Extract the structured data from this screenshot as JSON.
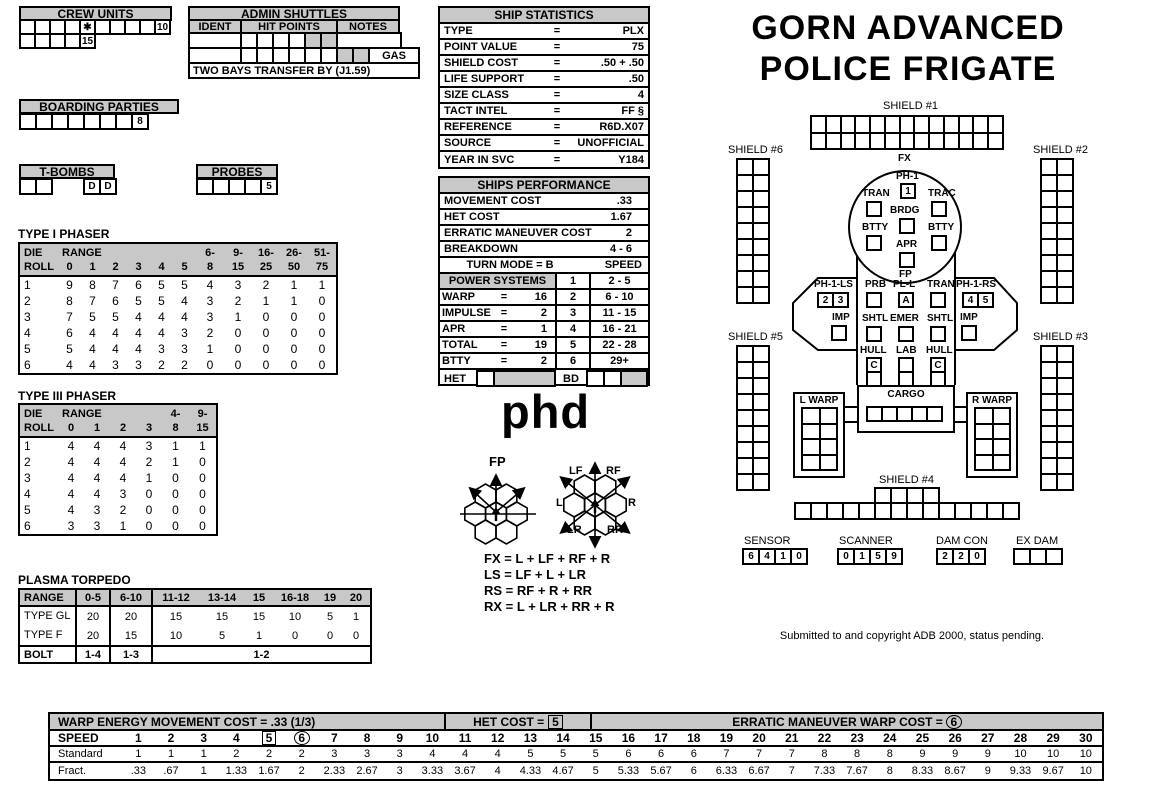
{
  "title": {
    "line1": "GORN ADVANCED",
    "line2": "POLICE FRIGATE"
  },
  "colors": {
    "ink": "#000000",
    "panel_gray": "#c8c8c8",
    "paper": "#ffffff"
  },
  "crew_units": {
    "title": "CREW UNITS",
    "row1": [
      "",
      "",
      "",
      "",
      "✱",
      "",
      "",
      "",
      "",
      "10"
    ],
    "row2": [
      "",
      "",
      "",
      "",
      "15"
    ]
  },
  "admin_shuttles": {
    "title": "ADMIN SHUTTLES",
    "col_ident": "IDENT",
    "col_hit": "HIT POINTS",
    "col_notes": "NOTES",
    "row1": [
      "",
      "",
      "",
      "",
      "~",
      "~"
    ],
    "row2": [
      "",
      "",
      "",
      "",
      "",
      "",
      "~",
      "~"
    ],
    "gas": "GAS",
    "note": "TWO BAYS TRANSFER BY (J1.59)"
  },
  "boarding_parties": {
    "title": "BOARDING PARTIES",
    "cells": [
      "",
      "",
      "",
      "",
      "",
      "",
      "",
      "8"
    ]
  },
  "t_bombs": {
    "title": "T-BOMBS",
    "left": [
      "",
      ""
    ],
    "right": [
      "D",
      "D"
    ]
  },
  "probes": {
    "title": "PROBES",
    "cells": [
      "",
      "",
      "",
      "",
      "5"
    ]
  },
  "ship_statistics": {
    "title": "SHIP STATISTICS",
    "rows": [
      [
        "TYPE",
        "=",
        "PLX"
      ],
      [
        "POINT VALUE",
        "=",
        "75"
      ],
      [
        "SHIELD COST",
        "=",
        ".50 + .50"
      ],
      [
        "LIFE SUPPORT",
        "=",
        ".50"
      ],
      [
        "SIZE CLASS",
        "=",
        "4"
      ],
      [
        "TACT INTEL",
        "=",
        "FF §"
      ],
      [
        "REFERENCE",
        "=",
        "R6D.X07"
      ],
      [
        "SOURCE",
        "=",
        "UNOFFICIAL"
      ],
      [
        "YEAR IN SVC",
        "=",
        "Y184"
      ]
    ]
  },
  "ships_performance": {
    "title": "SHIPS PERFORMANCE",
    "rows": [
      [
        "MOVEMENT COST",
        ".33"
      ],
      [
        "HET COST",
        "1.67"
      ],
      [
        "ERRATIC MANEUVER COST",
        "2"
      ],
      [
        "BREAKDOWN",
        "4 - 6"
      ]
    ],
    "turn_mode": "TURN MODE = B",
    "speed_header": "SPEED",
    "power_title": "POWER SYSTEMS",
    "power_rows": [
      [
        "WARP",
        "=",
        "16"
      ],
      [
        "IMPULSE",
        "=",
        "2"
      ],
      [
        "APR",
        "=",
        "1"
      ],
      [
        "TOTAL",
        "=",
        "19"
      ],
      [
        "BTTY",
        "=",
        "2"
      ]
    ],
    "speed_rows": [
      [
        "1",
        "2 - 5"
      ],
      [
        "2",
        "6 - 10"
      ],
      [
        "3",
        "11 - 15"
      ],
      [
        "4",
        "16 - 21"
      ],
      [
        "5",
        "22 - 28"
      ],
      [
        "6",
        "29+"
      ]
    ],
    "het_label": "HET",
    "bd_label": "BD"
  },
  "type1_phaser": {
    "title": "TYPE I PHASER",
    "header_top": [
      "DIE",
      "RANGE",
      "",
      "",
      "",
      "",
      "",
      "6-",
      "9-",
      "16-",
      "26-",
      "51-"
    ],
    "header_bot": [
      "ROLL",
      "0",
      "1",
      "2",
      "3",
      "4",
      "5",
      "8",
      "15",
      "25",
      "50",
      "75"
    ],
    "rows": [
      [
        "1",
        "9",
        "8",
        "7",
        "6",
        "5",
        "5",
        "4",
        "3",
        "2",
        "1",
        "1"
      ],
      [
        "2",
        "8",
        "7",
        "6",
        "5",
        "5",
        "4",
        "3",
        "2",
        "1",
        "1",
        "0"
      ],
      [
        "3",
        "7",
        "5",
        "5",
        "4",
        "4",
        "4",
        "3",
        "1",
        "0",
        "0",
        "0"
      ],
      [
        "4",
        "6",
        "4",
        "4",
        "4",
        "4",
        "3",
        "2",
        "0",
        "0",
        "0",
        "0"
      ],
      [
        "5",
        "5",
        "4",
        "4",
        "4",
        "3",
        "3",
        "1",
        "0",
        "0",
        "0",
        "0"
      ],
      [
        "6",
        "4",
        "4",
        "3",
        "3",
        "2",
        "2",
        "0",
        "0",
        "0",
        "0",
        "0"
      ]
    ]
  },
  "type3_phaser": {
    "title": "TYPE III PHASER",
    "header_top": [
      "DIE",
      "RANGE",
      "",
      "",
      "",
      "4-",
      "9-"
    ],
    "header_bot": [
      "ROLL",
      "0",
      "1",
      "2",
      "3",
      "8",
      "15"
    ],
    "rows": [
      [
        "1",
        "4",
        "4",
        "4",
        "3",
        "1",
        "1"
      ],
      [
        "2",
        "4",
        "4",
        "4",
        "2",
        "1",
        "0"
      ],
      [
        "3",
        "4",
        "4",
        "4",
        "1",
        "0",
        "0"
      ],
      [
        "4",
        "4",
        "4",
        "3",
        "0",
        "0",
        "0"
      ],
      [
        "5",
        "4",
        "3",
        "2",
        "0",
        "0",
        "0"
      ],
      [
        "6",
        "3",
        "3",
        "1",
        "0",
        "0",
        "0"
      ]
    ]
  },
  "plasma": {
    "title": "PLASMA TORPEDO",
    "header": [
      "RANGE",
      "0-5",
      "6-10",
      "11-12",
      "13-14",
      "15",
      "16-18",
      "19",
      "20"
    ],
    "rows": [
      [
        "TYPE GL",
        "20",
        "20",
        "15",
        "15",
        "15",
        "10",
        "5",
        "1"
      ],
      [
        "TYPE F",
        "20",
        "15",
        "10",
        "5",
        "1",
        "0",
        "0",
        "0"
      ]
    ],
    "bolt": [
      "BOLT",
      "1-4",
      "1-3",
      "1-2"
    ]
  },
  "phd_text": "phd",
  "arcs": {
    "fp_label": "FP",
    "right_labels": {
      "lf": "LF",
      "rf": "RF",
      "l": "L",
      "r": "R",
      "lr": "LR",
      "rr": "RR"
    },
    "formulas": [
      "FX = L + LF + RF + R",
      "LS = LF + L + LR",
      "RS = RF + R + RR",
      "RX = L + LR + RR + R"
    ]
  },
  "diagram": {
    "fx_label": "FX",
    "fp_label": "FP",
    "shield1": {
      "label": "SHIELD #1",
      "grid": {
        "cols": 13,
        "rows": 2
      }
    },
    "shield2": {
      "label": "SHIELD #2",
      "grid": {
        "cols": 2,
        "rows": 9
      }
    },
    "shield3": {
      "label": "SHIELD #3",
      "grid": {
        "cols": 2,
        "rows": 9
      }
    },
    "shield4": {
      "label": "SHIELD #4",
      "top": {
        "cols": 4,
        "rows": 1
      },
      "bottom": {
        "cols": 14,
        "rows": 1
      }
    },
    "shield5": {
      "label": "SHIELD #5",
      "grid": {
        "cols": 2,
        "rows": 9
      }
    },
    "shield6": {
      "label": "SHIELD #6",
      "grid": {
        "cols": 2,
        "rows": 9
      }
    },
    "saucer": {
      "ph1": "PH-1",
      "ph1_box": "1",
      "tran": "TRAN",
      "trac": "TRAC",
      "brdg": "BRDG",
      "btty_left": "BTTY",
      "btty_right": "BTTY",
      "apr": "APR"
    },
    "left_wing": {
      "label": "PH-1-LS",
      "box1": "2",
      "box2": "3",
      "imp": "IMP"
    },
    "right_wing": {
      "label": "PH-1-RS",
      "box1": "4",
      "box2": "5",
      "imp": "IMP"
    },
    "mid": {
      "prb": "PRB",
      "pll": "PL-L",
      "pll_box": "A",
      "tran": "TRAN",
      "shtl_left": "SHTL",
      "emer": "EMER",
      "shtl_right": "SHTL",
      "hull_left": "HULL",
      "lab": "LAB",
      "hull_right": "HULL",
      "hull_box": "C"
    },
    "lwarp": {
      "label": "L WARP",
      "grid": {
        "cols": 2,
        "rows": 4
      }
    },
    "cargo": {
      "label": "CARGO",
      "cells": [
        "",
        "",
        "",
        "",
        ""
      ]
    },
    "rwarp": {
      "label": "R WARP",
      "grid": {
        "cols": 2,
        "rows": 4
      }
    },
    "sensor": {
      "label": "SENSOR",
      "cells": [
        "6",
        "4",
        "1",
        "0"
      ]
    },
    "scanner": {
      "label": "SCANNER",
      "cells": [
        "0",
        "1",
        "5",
        "9"
      ]
    },
    "damcon": {
      "label": "DAM CON",
      "cells": [
        "2",
        "2",
        "0"
      ]
    },
    "exdam": {
      "label": "EX DAM",
      "cells": [
        "",
        "",
        ""
      ]
    }
  },
  "copyright": "Submitted to and copyright ADB 2000, status pending.",
  "speed_table": {
    "warp_header": "WARP ENERGY MOVEMENT COST = .33  (1/3)",
    "het_header": "HET COST =",
    "het_value": "5",
    "erratic_header": "ERRATIC MANEUVER WARP COST =",
    "erratic_value": "6",
    "speed_label": "SPEED",
    "standard_label": "Standard",
    "fract_label": "Fract.",
    "boxed": "5",
    "circled": "6",
    "speeds": [
      "1",
      "2",
      "3",
      "4",
      "5",
      "6",
      "7",
      "8",
      "9",
      "10",
      "11",
      "12",
      "13",
      "14",
      "15",
      "16",
      "17",
      "18",
      "19",
      "20",
      "21",
      "22",
      "23",
      "24",
      "25",
      "26",
      "27",
      "28",
      "29",
      "30"
    ],
    "standard": [
      "1",
      "1",
      "1",
      "2",
      "2",
      "2",
      "3",
      "3",
      "3",
      "4",
      "4",
      "4",
      "5",
      "5",
      "5",
      "6",
      "6",
      "6",
      "7",
      "7",
      "7",
      "8",
      "8",
      "8",
      "9",
      "9",
      "9",
      "10",
      "10",
      "10"
    ],
    "fract": [
      ".33",
      ".67",
      "1",
      "1.33",
      "1.67",
      "2",
      "2.33",
      "2.67",
      "3",
      "3.33",
      "3.67",
      "4",
      "4.33",
      "4.67",
      "5",
      "5.33",
      "5.67",
      "6",
      "6.33",
      "6.67",
      "7",
      "7.33",
      "7.67",
      "8",
      "8.33",
      "8.67",
      "9",
      "9.33",
      "9.67",
      "10"
    ]
  }
}
